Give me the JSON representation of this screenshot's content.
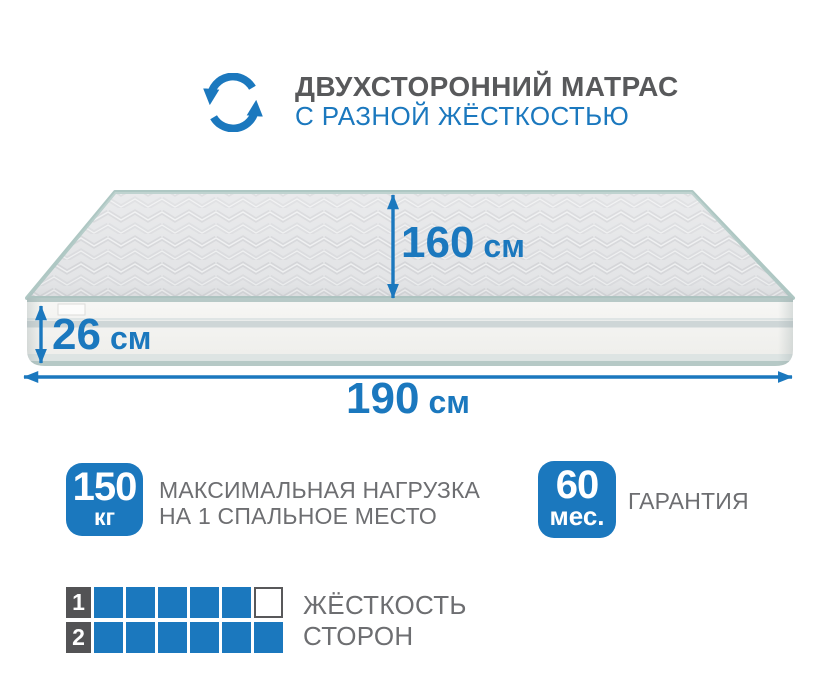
{
  "header": {
    "title_line1": "ДВУХСТОРОННИЙ МАТРАС",
    "title_line2": "С РАЗНОЙ ЖЁСТКОСТЬЮ",
    "icon": "rotate-arrows-icon"
  },
  "mattress": {
    "dimensions": {
      "top_width": {
        "value": "160",
        "unit": "см"
      },
      "thickness": {
        "value": "26",
        "unit": "см"
      },
      "length": {
        "value": "190",
        "unit": "см"
      }
    }
  },
  "badges": [
    {
      "value": "150",
      "unit": "кг",
      "label_line1": "МАКСИМАЛЬНАЯ НАГРУЗКА",
      "label_line2": "НА 1 СПАЛЬНОЕ МЕСТО"
    },
    {
      "value": "60",
      "unit": "мес.",
      "label_line1": "ГАРАНТИЯ"
    }
  ],
  "firmness": {
    "label_line1": "ЖЁСТКОСТЬ",
    "label_line2": "СТОРОН",
    "rows": [
      {
        "number": "1",
        "filled": 5,
        "total": 6
      },
      {
        "number": "2",
        "filled": 6,
        "total": 6
      }
    ]
  },
  "colors": {
    "accent_blue": "#1B78BE",
    "title_gray": "#58595B",
    "text_gray": "#6D6E71",
    "dark_square": "#535355",
    "empty_cell_border": "#58585A",
    "piping_teal": "#AEC7C3"
  }
}
